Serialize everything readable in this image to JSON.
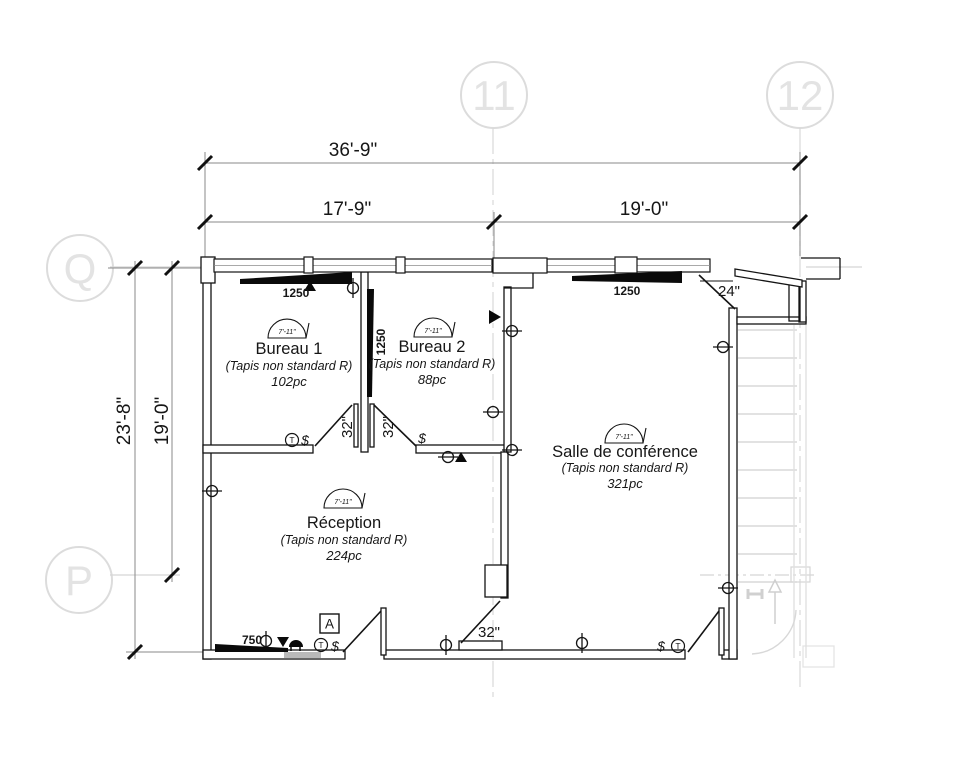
{
  "grid": {
    "columns": [
      {
        "label": "11"
      },
      {
        "label": "12"
      }
    ],
    "rows": [
      {
        "label": "Q"
      },
      {
        "label": "P"
      }
    ]
  },
  "dimensions": {
    "top_overall": "36'-9\"",
    "top_left": "17'-9\"",
    "top_right": "19'-0\"",
    "left_overall": "23'-8\"",
    "left_inner": "19'-0\""
  },
  "rooms": [
    {
      "name": "Bureau 1",
      "note": "(Tapis non standard R)",
      "area": "102pc",
      "ceiling": "7'-11\""
    },
    {
      "name": "Bureau 2",
      "note": "(Tapis non standard R)",
      "area": "88pc",
      "ceiling": "7'-11\""
    },
    {
      "name": "Salle de conférence",
      "note": "(Tapis non standard R)",
      "area": "321pc",
      "ceiling": "7'-11\""
    },
    {
      "name": "Réception",
      "note": "(Tapis non standard R)",
      "area": "224pc",
      "ceiling": "7'-11\""
    }
  ],
  "diffusers": {
    "bureau1": "1250",
    "bureau2": "1250",
    "conference": "1250",
    "reception": "750"
  },
  "doors": {
    "bureau1": "32\"",
    "bureau2": "32\"",
    "side": "32\"",
    "rear": "24\""
  },
  "tags": {
    "section": "A",
    "thermostat": "T",
    "switch": "$"
  },
  "colors": {
    "line": "#141414",
    "grid": "#dcdcdc",
    "dim": "#8a8a8a",
    "stair": "#d8d8d8"
  }
}
